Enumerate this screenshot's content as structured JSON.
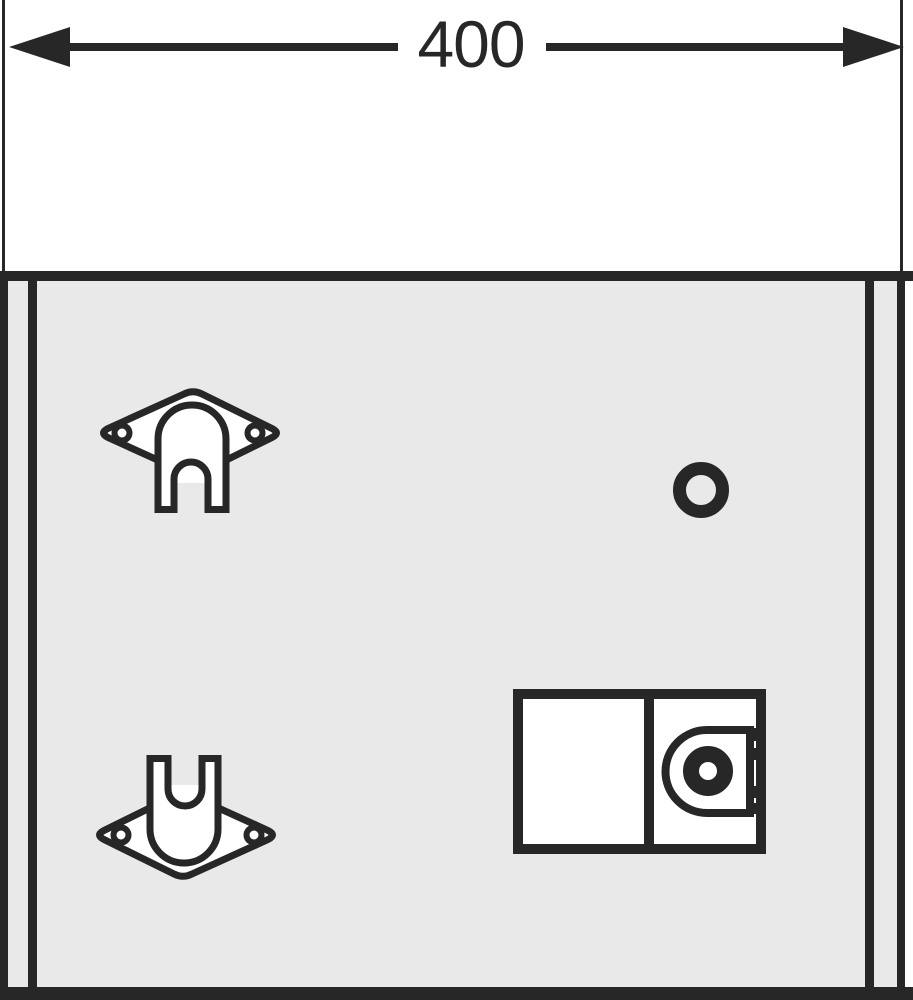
{
  "dimension": {
    "label": "400"
  },
  "colors": {
    "ink": "#272727",
    "panel": "#e9e9e9",
    "bg": "#ffffff",
    "fixture": "#ffffff"
  },
  "drawing": {
    "kind": "technical-dimension-drawing",
    "parts": {
      "dimension_line": "overall-width-dimension",
      "bracket_top": "wall-mounting-bracket",
      "bracket_bottom": "wall-mounting-bracket-inverted",
      "round_hole": "round-opening",
      "lock_module": "lock-latch-module-with-cylinder"
    }
  }
}
